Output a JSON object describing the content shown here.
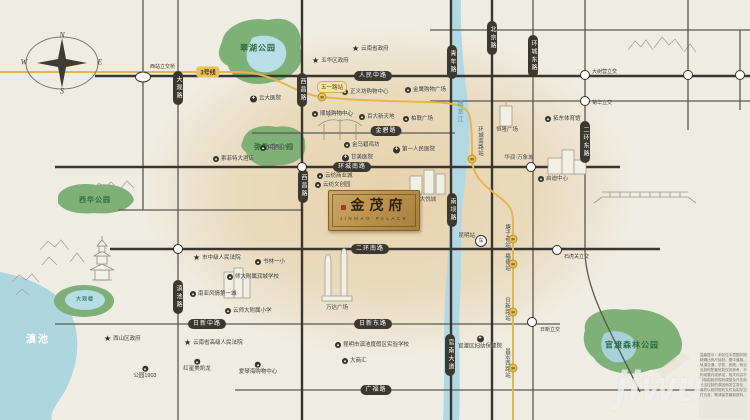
{
  "project": {
    "name": "金茂府",
    "name_en": "JINMAO PALACE"
  },
  "compass": {
    "n": "N",
    "e": "E",
    "s": "S",
    "w": "W"
  },
  "colors": {
    "park": "#7fb077",
    "water": "#b2d9e3",
    "road_dark": "#39362e",
    "metro_line": "#e3b64f",
    "plaque_gold": "#b8904c",
    "seal_red": "#a93524"
  },
  "watermark": "jiwu",
  "disclaimer": "温馨提示：本区位示意图非按精确比例尺绘制，图中道路、轨道交通、学校、医院、商业及其他配套信息仅供参考，不构成要约或承诺，相关内容不排除因政府规划调整及开发商无法控制的原因而发生变化，最终以政府规划文件及实际交付为准，敬请留意最新资料。",
  "parks": [
    {
      "label": "翠湖公园"
    },
    {
      "label": "弥勒寺公园"
    },
    {
      "label": "西华公园"
    },
    {
      "label": "大观楼"
    },
    {
      "label": "官渡森林公园"
    },
    {
      "label": "滇池"
    }
  ],
  "river": {
    "label": "盘龙江"
  },
  "roads": [
    {
      "label": "人民中路"
    },
    {
      "label": "金碧路"
    },
    {
      "label": "环城南路"
    },
    {
      "label": "二环南路"
    },
    {
      "label": "日新中路"
    },
    {
      "label": "日新东路"
    },
    {
      "label": "广福路"
    },
    {
      "label": "大观路"
    },
    {
      "label": "西昌路"
    },
    {
      "label": "西昌路"
    },
    {
      "label": "滇池路"
    },
    {
      "label": "青年路"
    },
    {
      "label": "南坝路"
    },
    {
      "label": "官南大道"
    },
    {
      "label": "北京路"
    },
    {
      "label": "环城东路"
    },
    {
      "label": "二环东路"
    }
  ],
  "metro": {
    "line_badge": "3号线",
    "station_badge": "五一路站",
    "stations": [
      {
        "label": "环城南路站"
      },
      {
        "label": "塘子巷站"
      },
      {
        "label": "福德站"
      },
      {
        "label": "日新路站"
      },
      {
        "label": "昌宏西路站"
      }
    ]
  },
  "interchanges": [
    {
      "label": "西站立交桥"
    },
    {
      "label": "大树营立交"
    },
    {
      "label": "菊华立交"
    },
    {
      "label": "石虎关立交"
    },
    {
      "label": "日新立交"
    }
  ],
  "stars": [
    {
      "label": "云南省政府"
    },
    {
      "label": "五华区政府"
    },
    {
      "label": "市中级人民法院"
    },
    {
      "label": "西山区政府"
    },
    {
      "label": "云南省高级人民法院"
    }
  ],
  "hospitals": [
    {
      "label": "云大医院"
    },
    {
      "label": "第一人民医院"
    },
    {
      "label": "甘美医院"
    },
    {
      "label": "官渡区妇幼保健院"
    }
  ],
  "pois": [
    {
      "label": "正义坊购物中心"
    },
    {
      "label": "金鹰购物广场"
    },
    {
      "label": "顺城购物中心"
    },
    {
      "label": "百大新天地"
    },
    {
      "label": "柏联广场"
    },
    {
      "label": "金马碧鸡坊"
    },
    {
      "label": "明通小学"
    },
    {
      "label": "索菲特大酒店"
    },
    {
      "label": "云纺商业城"
    },
    {
      "label": "云纺文创园"
    },
    {
      "label": "书林一小"
    },
    {
      "label": "师大附属润城学校"
    },
    {
      "label": "云师大附属小学"
    },
    {
      "label": "南亚风情第一城"
    },
    {
      "label": "红星美凯龙"
    },
    {
      "label": "爱琴海购物中心"
    },
    {
      "label": "大商汇"
    },
    {
      "label": "昆明市滇池度假区实验学校"
    },
    {
      "label": "公园1903"
    },
    {
      "label": "拓东体育馆"
    },
    {
      "label": "启迪中心"
    },
    {
      "label": "恒隆广场"
    },
    {
      "label": "大悦城"
    },
    {
      "label": "万达广场"
    },
    {
      "label": "华润·万象城"
    },
    {
      "label": "昆明站"
    }
  ],
  "icons": {
    "star": "★",
    "hospital": "+",
    "poi": "◆",
    "metro": "M",
    "train": "车"
  }
}
